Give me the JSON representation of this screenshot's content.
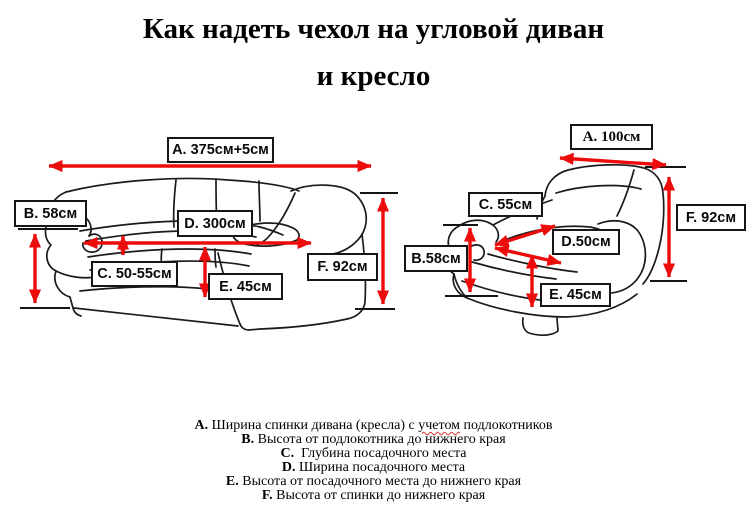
{
  "title": {
    "line1": "Как надеть чехол на угловой диван",
    "line2": "и кресло"
  },
  "sofa_diagram": {
    "subject": "угловой диван",
    "labels": {
      "a": "A. 375см+5см",
      "b": "B. 58см",
      "c": "C. 50-55см",
      "d": "D. 300см",
      "e": "E. 45см",
      "f": "F. 92см"
    }
  },
  "armchair_diagram": {
    "subject": "кресло",
    "labels": {
      "a": "A. 100см",
      "b": "B.58см",
      "c": "C. 55см",
      "d": "D.50см",
      "e": "E. 45см",
      "f": "F. 92см"
    }
  },
  "legend": {
    "items": [
      {
        "key": "A.",
        "pre": " Ширина спинки дивана (кресла) с ",
        "misspelled": "учетом",
        "post": " подлокотников"
      },
      {
        "key": "B.",
        "text": " Высота от подлокотника до нижнего края"
      },
      {
        "key": "C.",
        "text": "  Глубина посадочного места"
      },
      {
        "key": "D.",
        "text": " Ширина посадочного места"
      },
      {
        "key": "E.",
        "text": " Высота от посадочного места до нижнего края"
      },
      {
        "key": "F.",
        "text": " Высота от спинки до нижнего края"
      }
    ]
  },
  "colors": {
    "arrow_red": "#ed0c0c",
    "ref_line_black": "#141414",
    "sketch_line": "#1b1b1b"
  }
}
